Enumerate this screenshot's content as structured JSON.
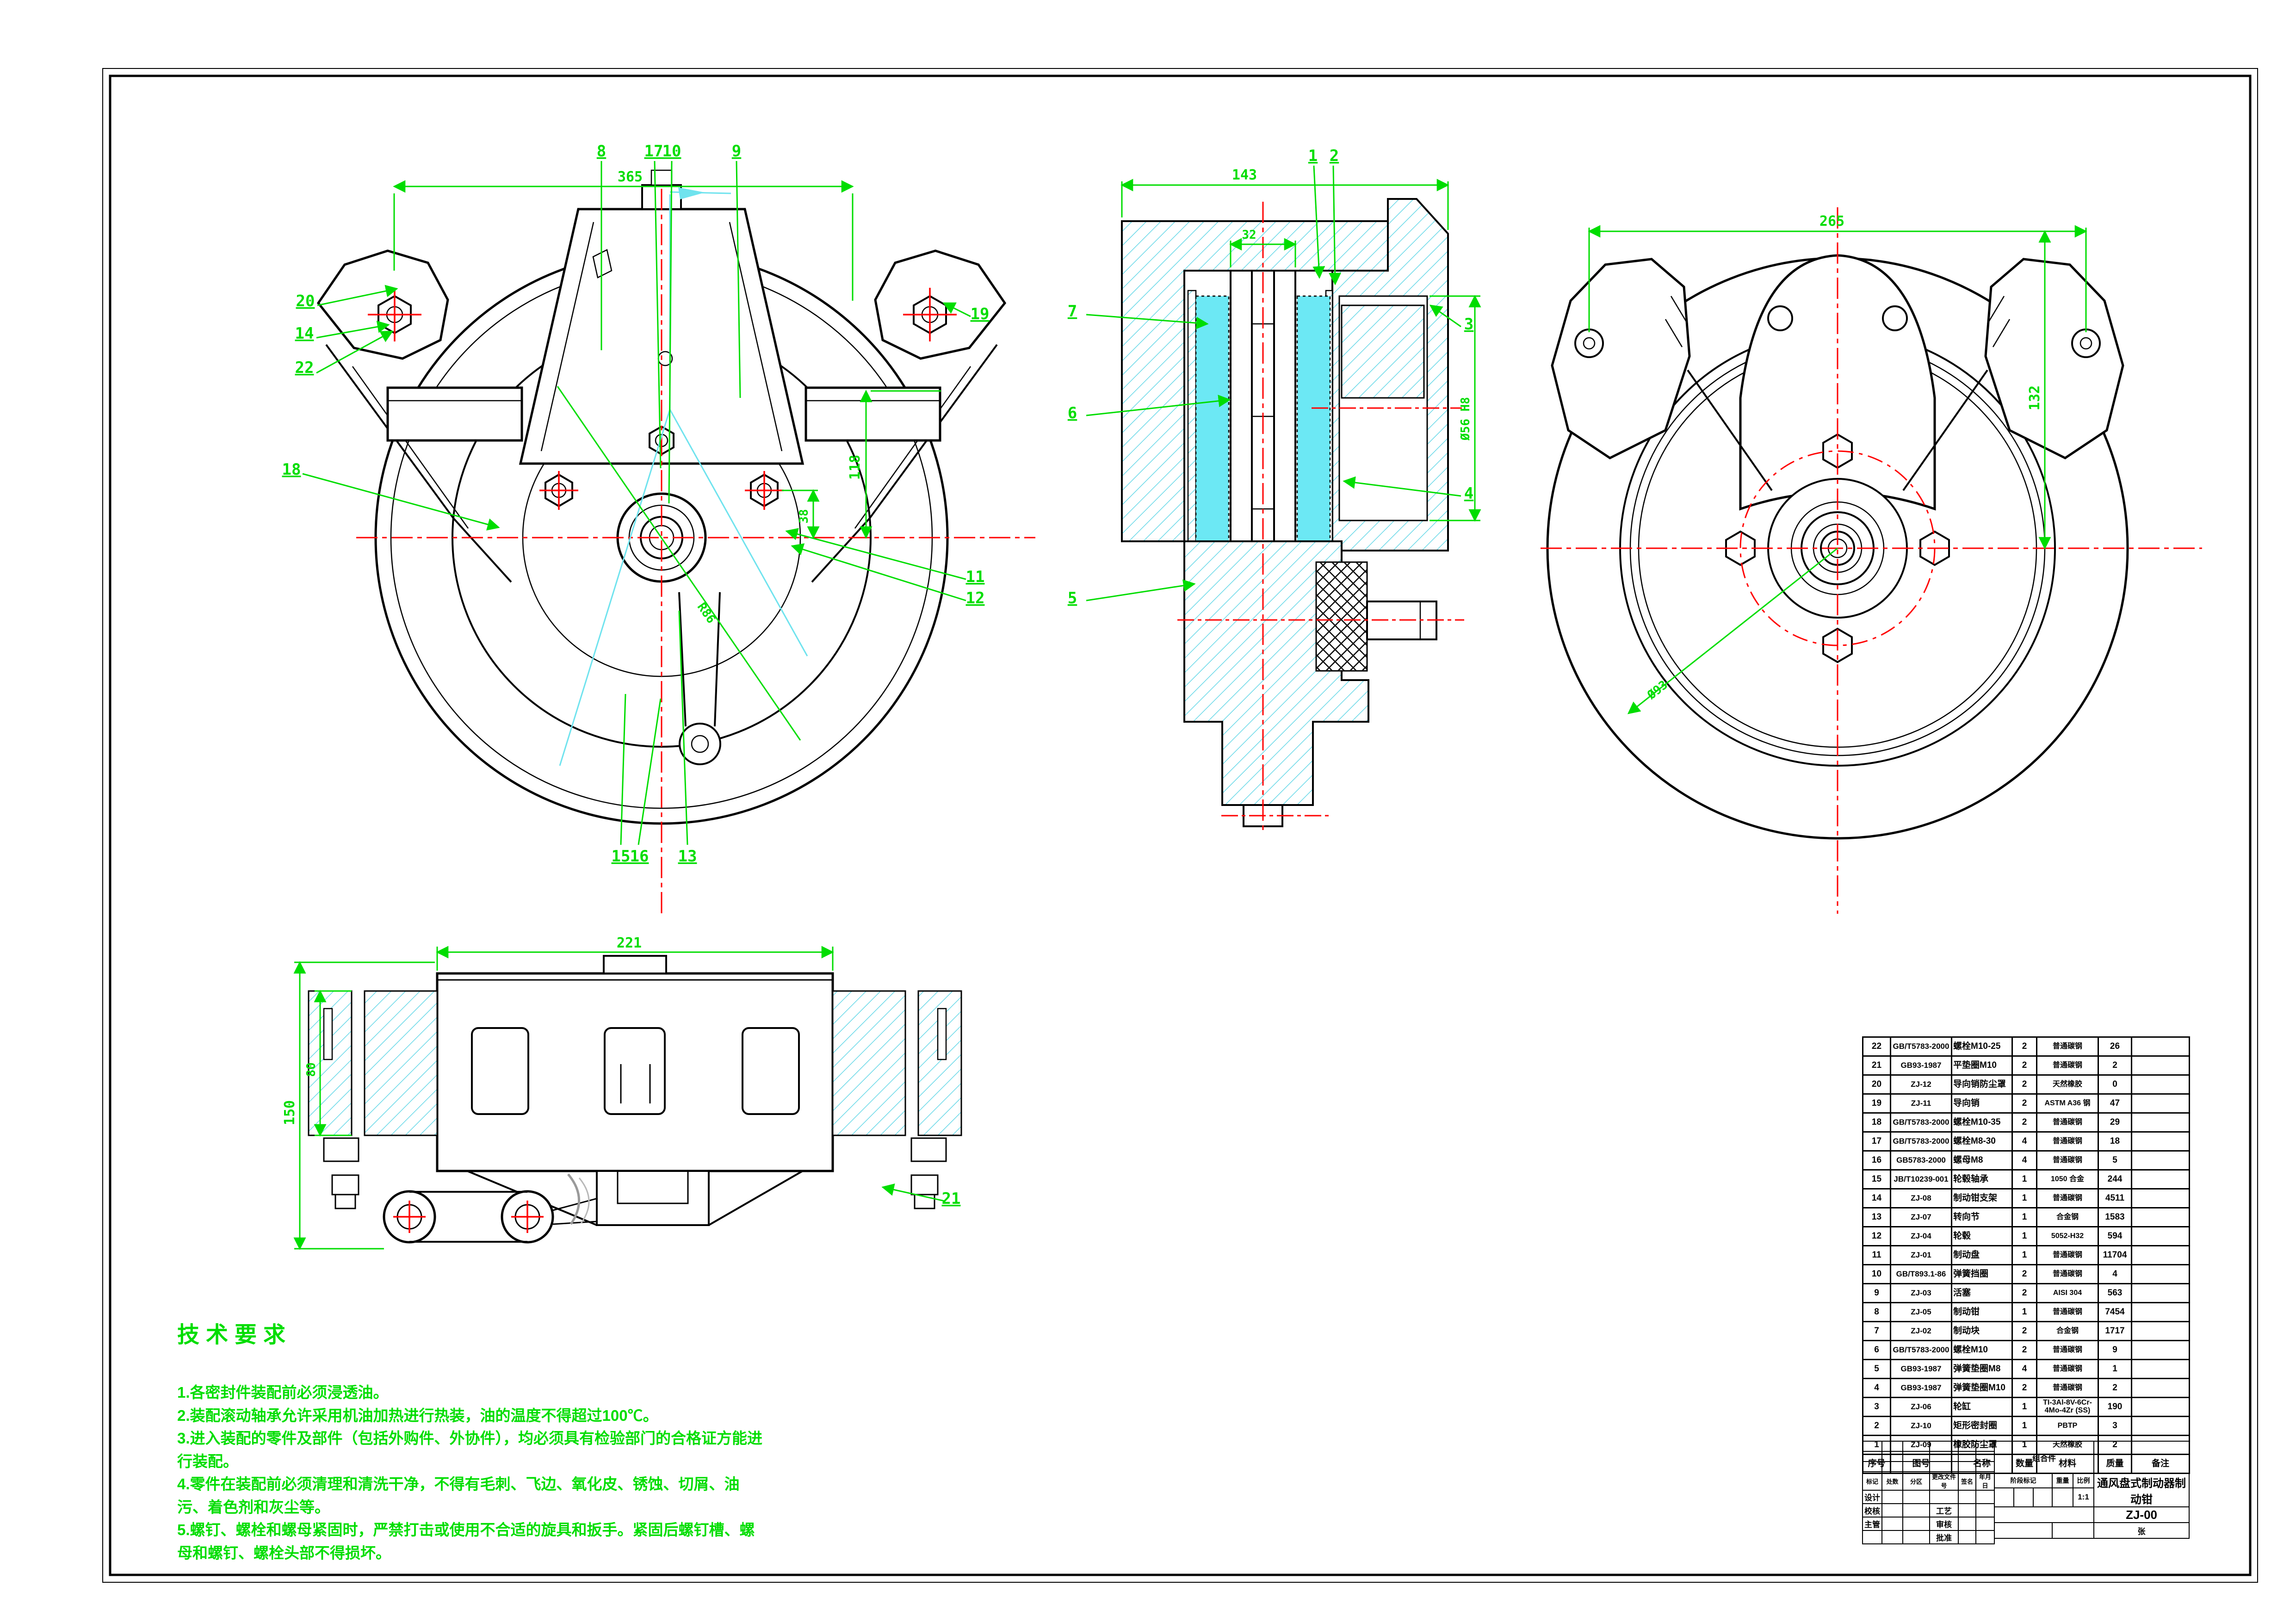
{
  "colors": {
    "dim_green": "#00dd00",
    "centerline_red": "#ff0000",
    "hatch_cyan": "#6ad9e8",
    "pad_fill": "#6ce8f4"
  },
  "v1": {
    "dim_width": "365",
    "dim_height": "118",
    "dim_offset": "38",
    "dim_radius": "R86",
    "c8": "8",
    "c9": "9",
    "c10": "10",
    "c11": "11",
    "c12": "12",
    "c13": "13",
    "c14": "14",
    "c15": "15",
    "c16": "16",
    "c17": "17",
    "c18": "18",
    "c19": "19",
    "c20": "20",
    "c22": "22"
  },
  "v2": {
    "dim_width": "143",
    "dim_inner": "32",
    "dim_bore": "Ø56 H8",
    "c1": "1",
    "c2": "2",
    "c3": "3",
    "c4": "4",
    "c5": "5",
    "c6": "6",
    "c7": "7"
  },
  "v3": {
    "dim_width": "265",
    "dim_height": "132",
    "dim_bolt_circle": "Ø93"
  },
  "v4": {
    "dim_width": "221",
    "dim_height": "150",
    "dim_pad": "80",
    "c21": "21"
  },
  "tech": {
    "title": "技术要求",
    "items": [
      "1.各密封件装配前必须浸透油。",
      "2.装配滚动轴承允许采用机油加热进行热装，油的温度不得超过100℃。",
      "3.进入装配的零件及部件（包括外购件、外协件），均必须具有检验部门的合格证方能进行装配。",
      "4.零件在装配前必须清理和清洗干净，不得有毛刺、飞边、氧化皮、锈蚀、切屑、油污、着色剂和灰尘等。",
      "5.螺钉、螺栓和螺母紧固时，严禁打击或使用不合适的旋具和扳手。紧固后螺钉槽、螺母和螺钉、螺栓头部不得损坏。"
    ]
  },
  "bom": {
    "headers": [
      "序号",
      "图号",
      "名称",
      "数量",
      "材料",
      "质量",
      "备注"
    ],
    "rows": [
      {
        "no": "22",
        "code": "GB/T5783-2000",
        "name": "螺栓M10-25",
        "qty": "2",
        "material": "普通碳钢",
        "weight": "26",
        "note": ""
      },
      {
        "no": "21",
        "code": "GB93-1987",
        "name": "平垫圈M10",
        "qty": "2",
        "material": "普通碳钢",
        "weight": "2",
        "note": ""
      },
      {
        "no": "20",
        "code": "ZJ-12",
        "name": "导向销防尘罩",
        "qty": "2",
        "material": "天然橡胶",
        "weight": "0",
        "note": ""
      },
      {
        "no": "19",
        "code": "ZJ-11",
        "name": "导向销",
        "qty": "2",
        "material": "ASTM A36 钢",
        "weight": "47",
        "note": ""
      },
      {
        "no": "18",
        "code": "GB/T5783-2000",
        "name": "螺栓M10-35",
        "qty": "2",
        "material": "普通碳钢",
        "weight": "29",
        "note": ""
      },
      {
        "no": "17",
        "code": "GB/T5783-2000",
        "name": "螺栓M8-30",
        "qty": "4",
        "material": "普通碳钢",
        "weight": "18",
        "note": ""
      },
      {
        "no": "16",
        "code": "GB5783-2000",
        "name": "螺母M8",
        "qty": "4",
        "material": "普通碳钢",
        "weight": "5",
        "note": ""
      },
      {
        "no": "15",
        "code": "JB/T10239-001",
        "name": "轮毂轴承",
        "qty": "1",
        "material": "1050 合金",
        "weight": "244",
        "note": ""
      },
      {
        "no": "14",
        "code": "ZJ-08",
        "name": "制动钳支架",
        "qty": "1",
        "material": "普通碳钢",
        "weight": "4511",
        "note": ""
      },
      {
        "no": "13",
        "code": "ZJ-07",
        "name": "转向节",
        "qty": "1",
        "material": "合金钢",
        "weight": "1583",
        "note": ""
      },
      {
        "no": "12",
        "code": "ZJ-04",
        "name": "轮毂",
        "qty": "1",
        "material": "5052-H32",
        "weight": "594",
        "note": ""
      },
      {
        "no": "11",
        "code": "ZJ-01",
        "name": "制动盘",
        "qty": "1",
        "material": "普通碳钢",
        "weight": "11704",
        "note": ""
      },
      {
        "no": "10",
        "code": "GB/T893.1-86",
        "name": "弹簧挡圈",
        "qty": "2",
        "material": "普通碳钢",
        "weight": "4",
        "note": ""
      },
      {
        "no": "9",
        "code": "ZJ-03",
        "name": "活塞",
        "qty": "2",
        "material": "AISI 304",
        "weight": "563",
        "note": ""
      },
      {
        "no": "8",
        "code": "ZJ-05",
        "name": "制动钳",
        "qty": "1",
        "material": "普通碳钢",
        "weight": "7454",
        "note": ""
      },
      {
        "no": "7",
        "code": "ZJ-02",
        "name": "制动块",
        "qty": "2",
        "material": "合金钢",
        "weight": "1717",
        "note": ""
      },
      {
        "no": "6",
        "code": "GB/T5783-2000",
        "name": "螺栓M10",
        "qty": "2",
        "material": "普通碳钢",
        "weight": "9",
        "note": ""
      },
      {
        "no": "5",
        "code": "GB93-1987",
        "name": "弹簧垫圈M8",
        "qty": "4",
        "material": "普通碳钢",
        "weight": "1",
        "note": ""
      },
      {
        "no": "4",
        "code": "GB93-1987",
        "name": "弹簧垫圈M10",
        "qty": "2",
        "material": "普通碳钢",
        "weight": "2",
        "note": ""
      },
      {
        "no": "3",
        "code": "ZJ-06",
        "name": "轮缸",
        "qty": "1",
        "material": "TI-3Al-8V-6Cr-4Mo-4Zr (SS)",
        "weight": "190",
        "note": ""
      },
      {
        "no": "2",
        "code": "ZJ-10",
        "name": "矩形密封圈",
        "qty": "1",
        "material": "PBTP",
        "weight": "3",
        "note": ""
      },
      {
        "no": "1",
        "code": "ZJ-09",
        "name": "橡胶防尘罩",
        "qty": "1",
        "material": "天然橡胶",
        "weight": "2",
        "note": ""
      }
    ]
  },
  "title_block": {
    "rev_headers": [
      "标记",
      "处数",
      "分区",
      "更改文件号",
      "签名",
      "年月日"
    ],
    "sig_design": "设计",
    "sig_check": "校核",
    "sig_chief": "主管",
    "sig_process": "工艺",
    "sig_audit": "审核",
    "sig_approve": "批准",
    "assembly": "组合件",
    "stage_label": "阶段标记",
    "weight_label": "重量",
    "scale_label": "比例",
    "scale_value": "1:1",
    "title": "通风盘式制动器制动钳",
    "drawing_no": "ZJ-00",
    "sheet": "张"
  }
}
